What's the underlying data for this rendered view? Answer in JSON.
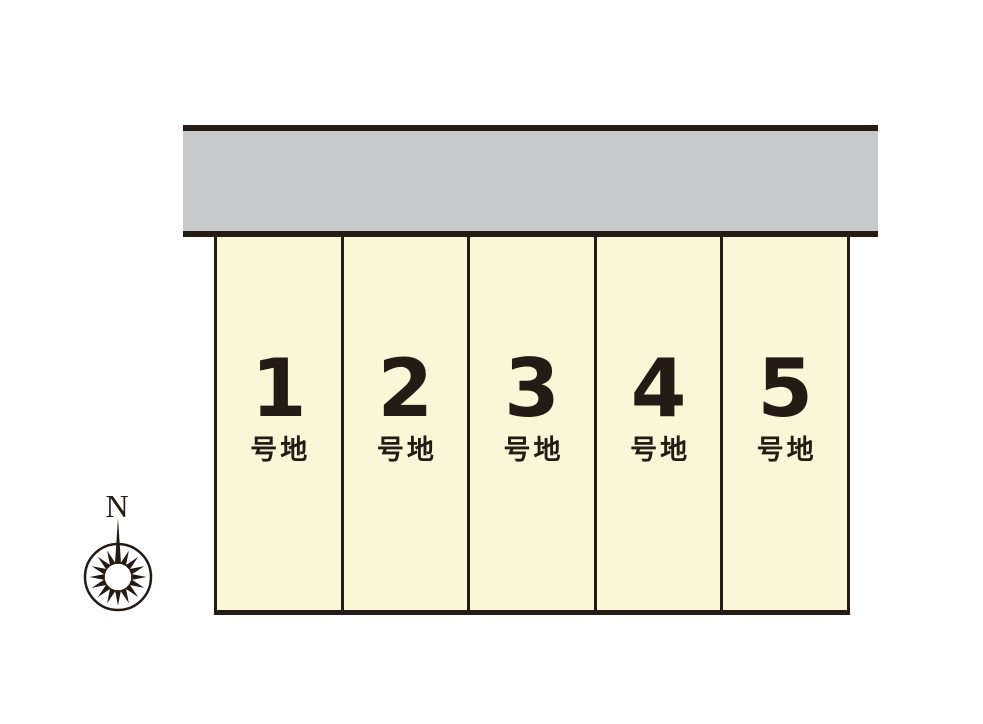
{
  "diagram": {
    "type": "residential-lot-layout",
    "colors": {
      "line": "#251a14",
      "road_fill": "#c8c9ca",
      "lot_fill": "#fbf6d7",
      "background": "#ffffff"
    },
    "road": {
      "label": ""
    },
    "lots": [
      {
        "number": "1",
        "suffix": "号地"
      },
      {
        "number": "2",
        "suffix": "号地"
      },
      {
        "number": "3",
        "suffix": "号地"
      },
      {
        "number": "4",
        "suffix": "号地"
      },
      {
        "number": "5",
        "suffix": "号地"
      }
    ],
    "compass": {
      "north_label": "N"
    }
  }
}
